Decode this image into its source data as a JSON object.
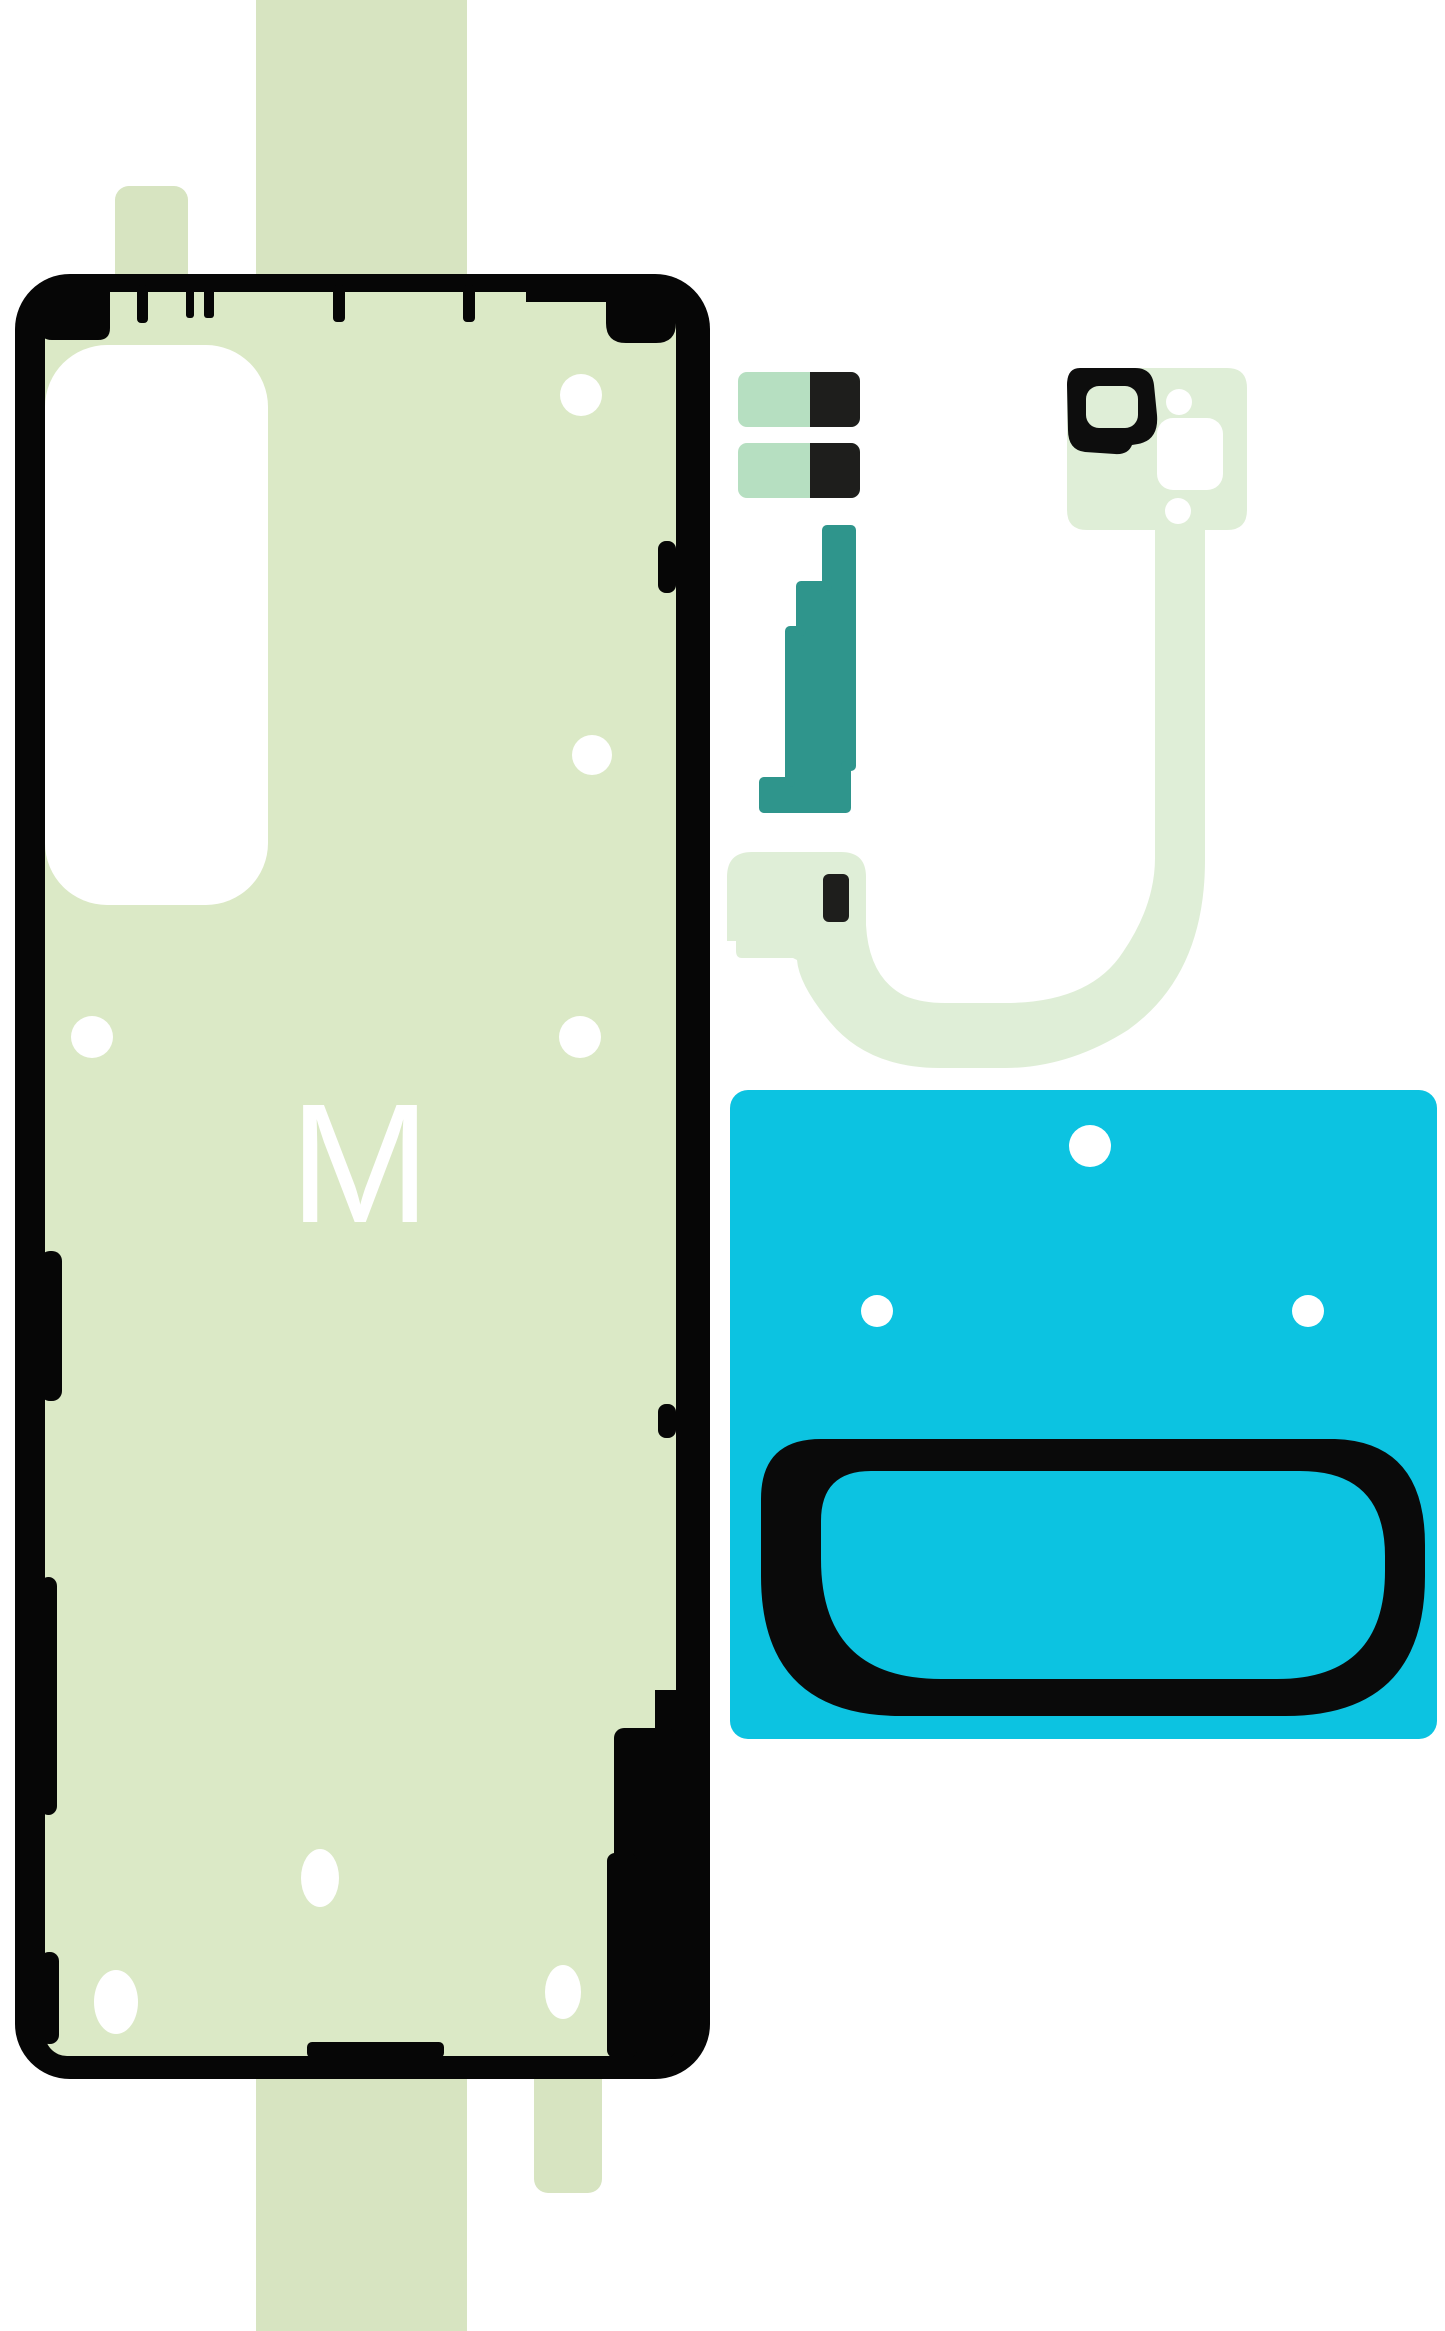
{
  "labels": {
    "sheet_marking": "M"
  },
  "colors": {
    "background": "#ffffff",
    "stripGreen": "#d7e4c1",
    "sheetGreen": "#dbe9c6",
    "frameBlack": "#060606",
    "cutoutWhite": "#ffffff",
    "mintGreen": "#b6dfc1",
    "chipBlack": "#1e1e1c",
    "teal": "#2f958c",
    "paleGreen": "#dfeed7",
    "camBlack": "#0d0d0d",
    "cyan": "#0cc3e1",
    "ringBlack": "#0a0a0a",
    "markWhite": "#ffffff"
  }
}
